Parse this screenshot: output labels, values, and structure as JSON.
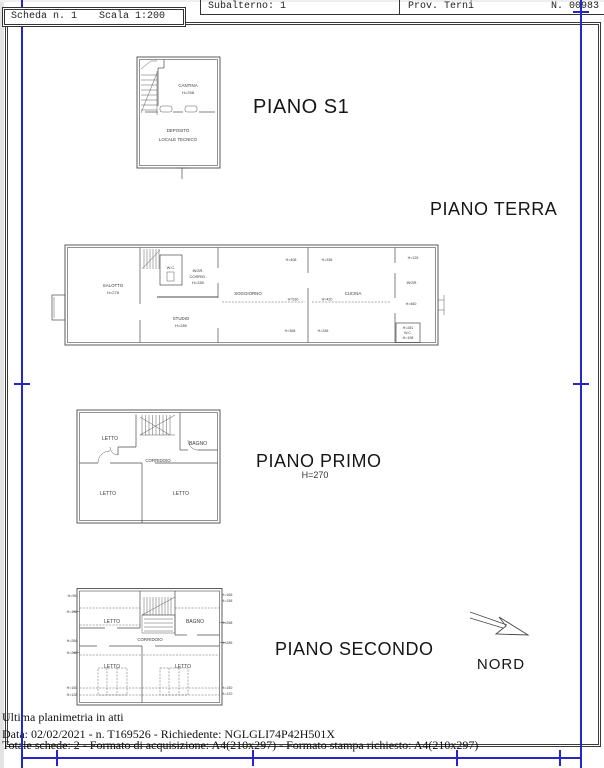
{
  "header": {
    "scheda": "Scheda n. 1",
    "scala": "Scala 1:200",
    "subalterno": "Subalterno: 1",
    "provincia": "Prov. Terni",
    "numero": "N. 00983"
  },
  "floor_s1": {
    "title": "PIANO S1",
    "cantina": "CANTINA",
    "cantina_h": "H=258",
    "deposito": "DEPOSITO",
    "locale_tecnico": "LOCALE TECNICO"
  },
  "floor_terra": {
    "title": "PIANO TERRA",
    "salotto": "SALOTTO",
    "salotto_h": "H=278",
    "wc": "W.C.",
    "ingr": "INGR.",
    "corrid": "CORRID.",
    "ingr_h": "H=280",
    "studio": "STUDIO",
    "studio_h": "H=280",
    "soggiorno": "SOGGIORNO",
    "soggiorno_h": "H=530",
    "cucina": "CUCINA",
    "cucina_h": "H=420",
    "h_top_left": "H=408",
    "h_top_mid": "H=336",
    "h_top_right": "H=125",
    "ingresso": "INGR.",
    "h_right": "H=460",
    "h_bottom_left": "H=368",
    "h_bottom_mid": "H=336",
    "wc2_h_top": "H=281",
    "wc2": "W.C.",
    "wc2_h_bottom": "H=198"
  },
  "floor_primo": {
    "title": "PIANO PRIMO",
    "height": "H=270",
    "letto_nw": "LETTO",
    "bagno": "BAGNO",
    "corridoio": "CORRIDOIO",
    "letto_sw": "LETTO",
    "letto_se": "LETTO"
  },
  "floor_secondo": {
    "title": "PIANO SECONDO",
    "letto_nw": "LETTO",
    "bagno": "BAGNO",
    "corridoio": "CORRIDOIO",
    "letto_sw": "LETTO",
    "letto_se": "LETTO",
    "left_heights": [
      "H=95",
      "H=150",
      "H=268",
      "H=268",
      "H=150",
      "H=128"
    ],
    "right_heights": [
      "H=165",
      "H=158",
      "H=268",
      "H=285",
      "H=150",
      "H=120"
    ]
  },
  "compass": {
    "label": "NORD"
  },
  "footer": {
    "line1": "Ultima planimetria in atti",
    "line2": "Data: 02/02/2021 - n. T169526 - Richiedente: NGLGLI74P42H501X",
    "line3": "Totale schede: 2 - Formato di acquisizione: A4(210x297)  - Formato stampa richiesto: A4(210x297)"
  },
  "colors": {
    "registration_mark": "#2525c8",
    "plan_line": "#4a4a4a"
  }
}
